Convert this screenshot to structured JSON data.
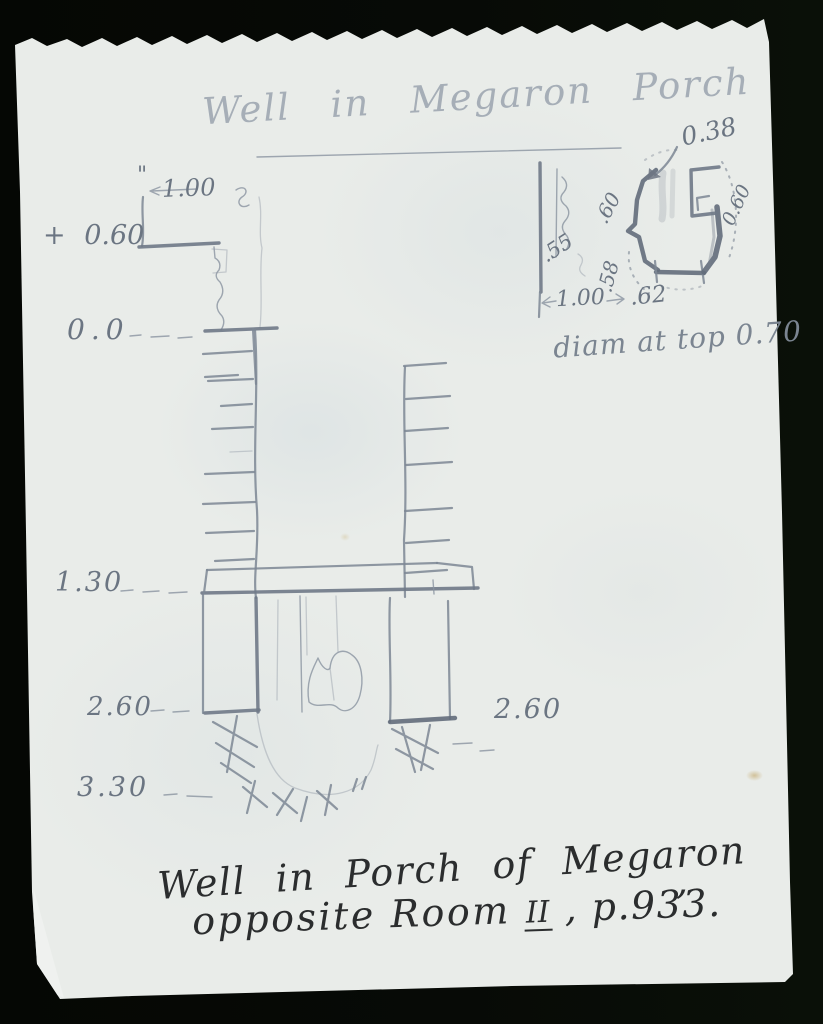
{
  "title": {
    "text": "Well in Megaron Porch"
  },
  "section": {
    "inch_tick": "\"",
    "top_width_dim": "1.00",
    "elevations": [
      {
        "label": "+ 0.60"
      },
      {
        "label": "0.0"
      },
      {
        "label": "1.30"
      },
      {
        "label": "2.60"
      },
      {
        "label": "3.30"
      }
    ],
    "right_depth_label": "2.60"
  },
  "plan": {
    "mouth_width": "0.38",
    "wall_left": ".60",
    "wall_right": "0.60",
    "outer_left": ".55",
    "inner_depth": ".58",
    "base_width": "1.00",
    "base_inner": ".62",
    "note": "diam at top 0.70"
  },
  "caption": {
    "line1": "Well in Porch of Megaron",
    "line1_comma": ",",
    "line2_prefix": "opposite Room",
    "room_numeral": "II",
    "line2_suffix": ", p.933."
  },
  "colors": {
    "paper": "#e9ece9",
    "background": "#060806",
    "pencil": "#76808c",
    "ink": "#2b2d2e"
  }
}
